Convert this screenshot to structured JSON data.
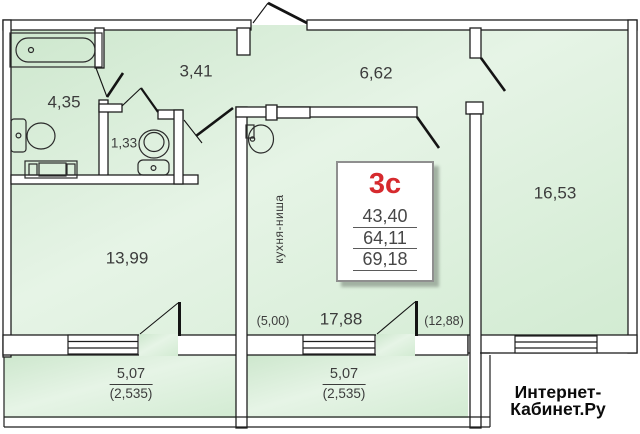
{
  "unit_card": {
    "type": "3с",
    "living_area": "43,40",
    "total_area": "64,11",
    "overall_area": "69,18"
  },
  "rooms": [
    {
      "id": "bathroom",
      "area": "4,35"
    },
    {
      "id": "wc",
      "area": "1,33"
    },
    {
      "id": "hallway",
      "area": "3,41"
    },
    {
      "id": "entrance-hall",
      "area": "6,62"
    },
    {
      "id": "room-left",
      "area": "13,99"
    },
    {
      "id": "room-right",
      "area": "16,53"
    },
    {
      "id": "kitchen-living",
      "area": "17,88"
    }
  ],
  "annotations": {
    "kitchen_niche": "кухня-ниша",
    "kitchen_area_coef": "(5,00)",
    "living_area_coef": "(12,88)"
  },
  "balconies": [
    {
      "area": "5,07",
      "reduced_area": "(2,535)"
    },
    {
      "area": "5,07",
      "reduced_area": "(2,535)"
    }
  ],
  "watermark": {
    "line1": "Интернет-",
    "line2": "Кабинет.Ру"
  },
  "colors": {
    "room_fill": "#d9eed9",
    "wall_line": "#1f1f1f",
    "unit_type_red": "#d62a2e",
    "text": "#3c3c3c"
  }
}
